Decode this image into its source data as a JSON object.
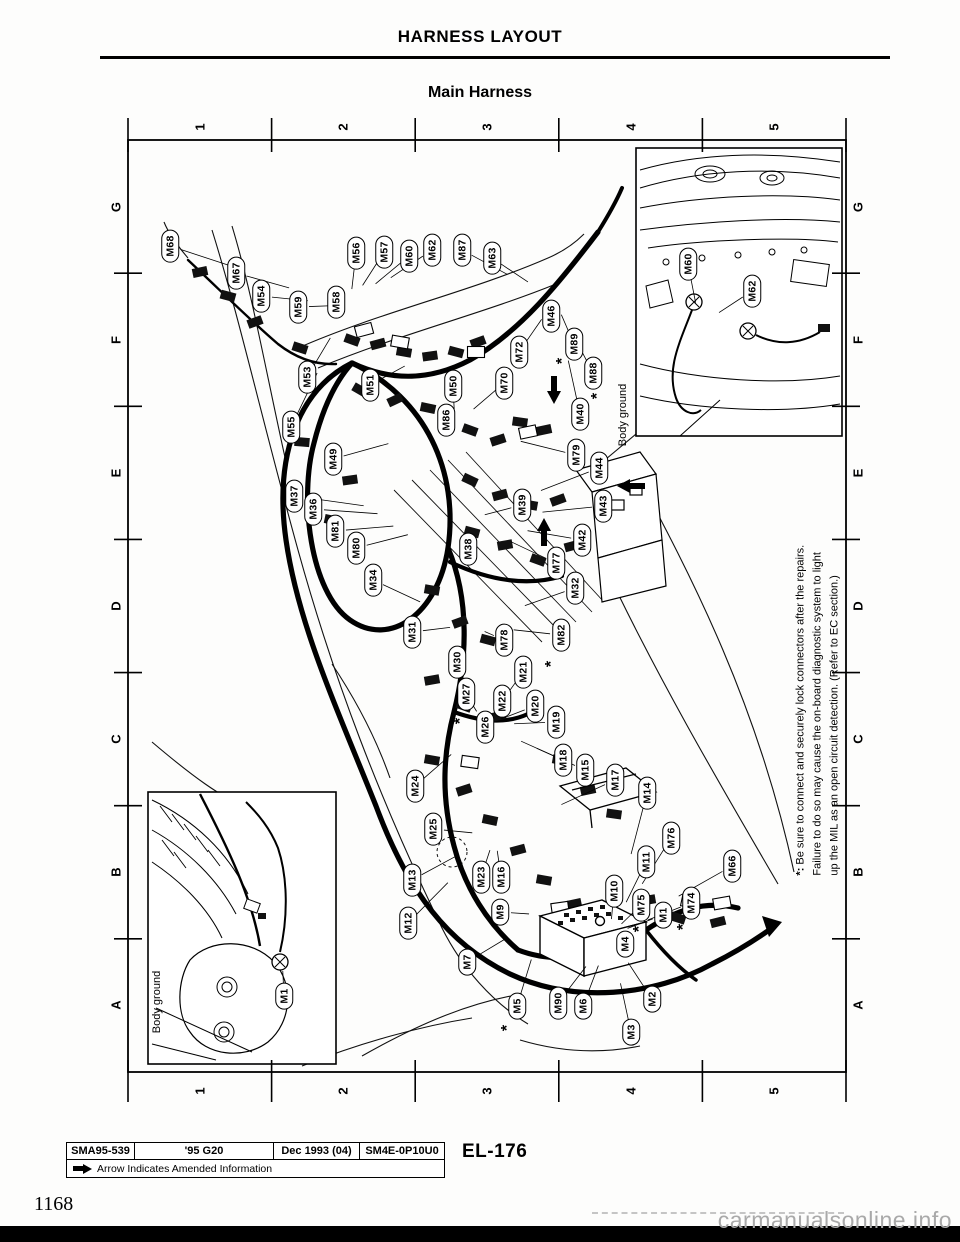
{
  "header": {
    "title": "HARNESS LAYOUT",
    "subtitle": "Main Harness"
  },
  "grid": {
    "columns": [
      "1",
      "2",
      "3",
      "4",
      "5"
    ],
    "rows": [
      "G",
      "F",
      "E",
      "D",
      "C",
      "B",
      "A"
    ]
  },
  "diagram": {
    "connectors": [
      {
        "id": "M68",
        "x": 170,
        "y": 246
      },
      {
        "id": "M67",
        "x": 236,
        "y": 273
      },
      {
        "id": "M54",
        "x": 261,
        "y": 296
      },
      {
        "id": "M59",
        "x": 298,
        "y": 307
      },
      {
        "id": "M58",
        "x": 336,
        "y": 302
      },
      {
        "id": "M56",
        "x": 356,
        "y": 253
      },
      {
        "id": "M57",
        "x": 384,
        "y": 252
      },
      {
        "id": "M60",
        "x": 409,
        "y": 256
      },
      {
        "id": "M62",
        "x": 432,
        "y": 250
      },
      {
        "id": "M87",
        "x": 462,
        "y": 250
      },
      {
        "id": "M63",
        "x": 492,
        "y": 258
      },
      {
        "id": "M46",
        "x": 551,
        "y": 316
      },
      {
        "id": "M72",
        "x": 519,
        "y": 352
      },
      {
        "id": "M89",
        "x": 574,
        "y": 344
      },
      {
        "id": "M53",
        "x": 307,
        "y": 377
      },
      {
        "id": "M51",
        "x": 370,
        "y": 385
      },
      {
        "id": "M50",
        "x": 453,
        "y": 386
      },
      {
        "id": "M70",
        "x": 504,
        "y": 383
      },
      {
        "id": "M88",
        "x": 593,
        "y": 373
      },
      {
        "id": "M86",
        "x": 446,
        "y": 420
      },
      {
        "id": "M40",
        "x": 580,
        "y": 414
      },
      {
        "id": "M55",
        "x": 291,
        "y": 427
      },
      {
        "id": "M49",
        "x": 333,
        "y": 459
      },
      {
        "id": "M79",
        "x": 576,
        "y": 455
      },
      {
        "id": "M44",
        "x": 599,
        "y": 468
      },
      {
        "id": "M37",
        "x": 294,
        "y": 496
      },
      {
        "id": "M36",
        "x": 313,
        "y": 509
      },
      {
        "id": "M39",
        "x": 522,
        "y": 505
      },
      {
        "id": "M43",
        "x": 603,
        "y": 506
      },
      {
        "id": "M81",
        "x": 335,
        "y": 531
      },
      {
        "id": "M80",
        "x": 356,
        "y": 548
      },
      {
        "id": "M42",
        "x": 582,
        "y": 540
      },
      {
        "id": "M34",
        "x": 373,
        "y": 580
      },
      {
        "id": "M38",
        "x": 468,
        "y": 549
      },
      {
        "id": "M77",
        "x": 556,
        "y": 563
      },
      {
        "id": "M32",
        "x": 575,
        "y": 588
      },
      {
        "id": "M31",
        "x": 412,
        "y": 632
      },
      {
        "id": "M78",
        "x": 504,
        "y": 640
      },
      {
        "id": "M82",
        "x": 561,
        "y": 635
      },
      {
        "id": "M30",
        "x": 457,
        "y": 662
      },
      {
        "id": "M27",
        "x": 466,
        "y": 694
      },
      {
        "id": "M22",
        "x": 502,
        "y": 701
      },
      {
        "id": "M21",
        "x": 523,
        "y": 672
      },
      {
        "id": "M26",
        "x": 485,
        "y": 727
      },
      {
        "id": "M20",
        "x": 535,
        "y": 706
      },
      {
        "id": "M19",
        "x": 556,
        "y": 722
      },
      {
        "id": "M18",
        "x": 563,
        "y": 760
      },
      {
        "id": "M15",
        "x": 585,
        "y": 770
      },
      {
        "id": "M17",
        "x": 615,
        "y": 780
      },
      {
        "id": "M14",
        "x": 647,
        "y": 793
      },
      {
        "id": "M24",
        "x": 415,
        "y": 786
      },
      {
        "id": "M25",
        "x": 433,
        "y": 829
      },
      {
        "id": "M76",
        "x": 671,
        "y": 838
      },
      {
        "id": "M13",
        "x": 412,
        "y": 880
      },
      {
        "id": "M11",
        "x": 646,
        "y": 862
      },
      {
        "id": "M66",
        "x": 732,
        "y": 866
      },
      {
        "id": "M23",
        "x": 481,
        "y": 877
      },
      {
        "id": "M16",
        "x": 501,
        "y": 877
      },
      {
        "id": "M10",
        "x": 614,
        "y": 891
      },
      {
        "id": "M12",
        "x": 408,
        "y": 923
      },
      {
        "id": "M9",
        "x": 500,
        "y": 912
      },
      {
        "id": "M75",
        "x": 641,
        "y": 905
      },
      {
        "id": "M1",
        "x": 663,
        "y": 915
      },
      {
        "id": "M74",
        "x": 691,
        "y": 903
      },
      {
        "id": "M4",
        "x": 625,
        "y": 944
      },
      {
        "id": "M7",
        "x": 467,
        "y": 962
      },
      {
        "id": "M5",
        "x": 517,
        "y": 1006
      },
      {
        "id": "M90",
        "x": 558,
        "y": 1003
      },
      {
        "id": "M6",
        "x": 583,
        "y": 1006
      },
      {
        "id": "M2",
        "x": 652,
        "y": 999
      },
      {
        "id": "M3",
        "x": 631,
        "y": 1032
      },
      {
        "id": "M60",
        "x": 688,
        "y": 264,
        "area": "inset-engine"
      },
      {
        "id": "M62",
        "x": 752,
        "y": 291,
        "area": "inset-engine"
      },
      {
        "id": "M1",
        "x": 284,
        "y": 996,
        "area": "inset-strut"
      }
    ],
    "asterisks": [
      {
        "near": "M89",
        "x": 563,
        "y": 361
      },
      {
        "near": "M88",
        "x": 598,
        "y": 396
      },
      {
        "near": "M82",
        "x": 552,
        "y": 664
      },
      {
        "near": "M27",
        "x": 461,
        "y": 721
      },
      {
        "near": "M75",
        "x": 640,
        "y": 929
      },
      {
        "near": "M74",
        "x": 684,
        "y": 927
      },
      {
        "near": "M5",
        "x": 508,
        "y": 1028
      }
    ],
    "amend_arrows": [
      {
        "x": 554,
        "y": 391,
        "dir": "down"
      },
      {
        "x": 630,
        "y": 486,
        "dir": "left"
      },
      {
        "x": 544,
        "y": 531,
        "dir": "up"
      }
    ],
    "ground_labels": [
      {
        "text": "Body ground",
        "x": 623,
        "y": 415
      },
      {
        "text": "Body ground",
        "x": 157,
        "y": 1002
      }
    ],
    "note": {
      "marker": "*:",
      "symbol": "*",
      "lines": [
        "Be sure to connect and securely lock connectors after the repairs.",
        "Failure to do so may cause the on-board diagnostic system to light",
        "up the MIL as an open circuit detection. (Refer to EC section.)"
      ]
    }
  },
  "footer": {
    "cells": [
      "SMA95-539",
      "'95 G20",
      "Dec 1993 (04)",
      "SM4E-0P10U0"
    ],
    "amended_note": "Arrow Indicates Amended Information",
    "page_code": "EL-176",
    "page_number": "1168",
    "watermark": "carmanualsonline.info"
  }
}
